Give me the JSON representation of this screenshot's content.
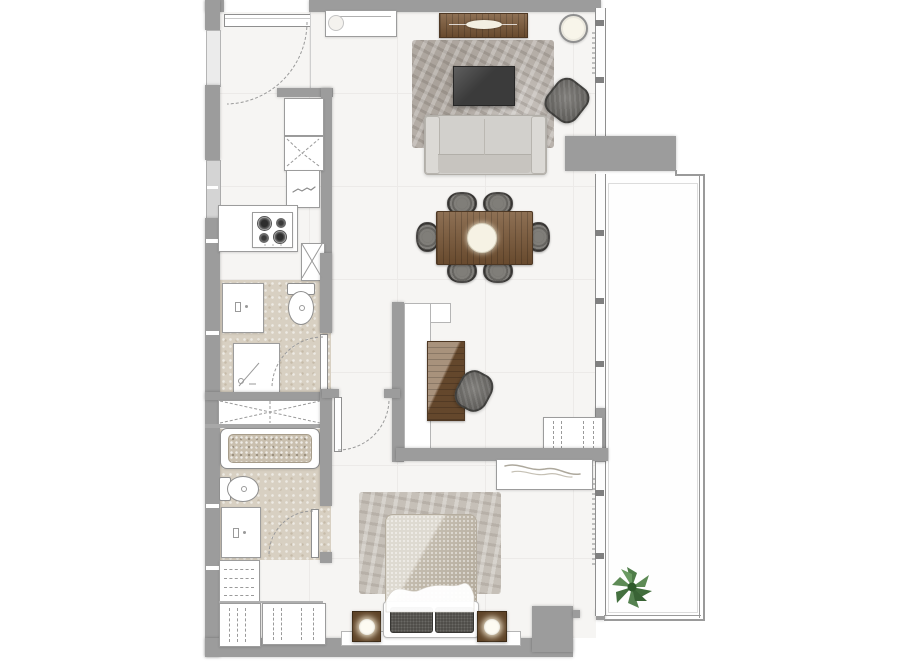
{
  "colors": {
    "canvas_bg": "#ffffff",
    "floor": "#f6f5f3",
    "floor_line": "#eceae8",
    "wall": "#9c9c9c",
    "window_line": "#8f8f8f",
    "bath_floor": "#d8d0c2",
    "wood_mid": "#7a5736",
    "rug_living": "#b5aea7",
    "bed_rug": "#c6c0b8",
    "sofa": "#d2d0cc",
    "chair_dark": "#6e6c68",
    "tv_black": "#3b3b3b",
    "cream": "#f8f5ea",
    "duvet": "#cfc8bb",
    "pillow_dark": "#4d4c48",
    "nightstand_wood": "#5e4327",
    "lamp_glow": "#fdfbf2",
    "plant_green": "#5d8a55",
    "plant_green_dark": "#416d3c"
  },
  "floorplan": {
    "rooms": [
      "entry",
      "kitchen",
      "living-room",
      "dining-area",
      "corridor",
      "guest-bathroom",
      "master-bathroom",
      "study-nook",
      "wardrobe-area",
      "bedroom",
      "balcony"
    ],
    "furniture": [
      "entry-console",
      "media-console",
      "round-side-table",
      "living-rug",
      "coffee-table",
      "accent-armchair",
      "sofa",
      "dining-table",
      "dining-chair",
      "table-centerpiece",
      "tall-cabinet",
      "corner-unit",
      "kitchen-sink",
      "cooktop-4-burner",
      "appliance-box",
      "kitchen-counter",
      "guest-vanity",
      "guest-toilet",
      "shower",
      "linen-closet",
      "bathtub",
      "master-toilet",
      "master-vanity",
      "shelf-unit",
      "hanging-wardrobe",
      "desk-counter",
      "desk-wood",
      "desk-chair",
      "dashed-closet",
      "bedroom-dresser",
      "bedroom-rug",
      "double-bed",
      "pillow",
      "nightstand-with-lamp",
      "bench",
      "balcony-plant"
    ]
  }
}
